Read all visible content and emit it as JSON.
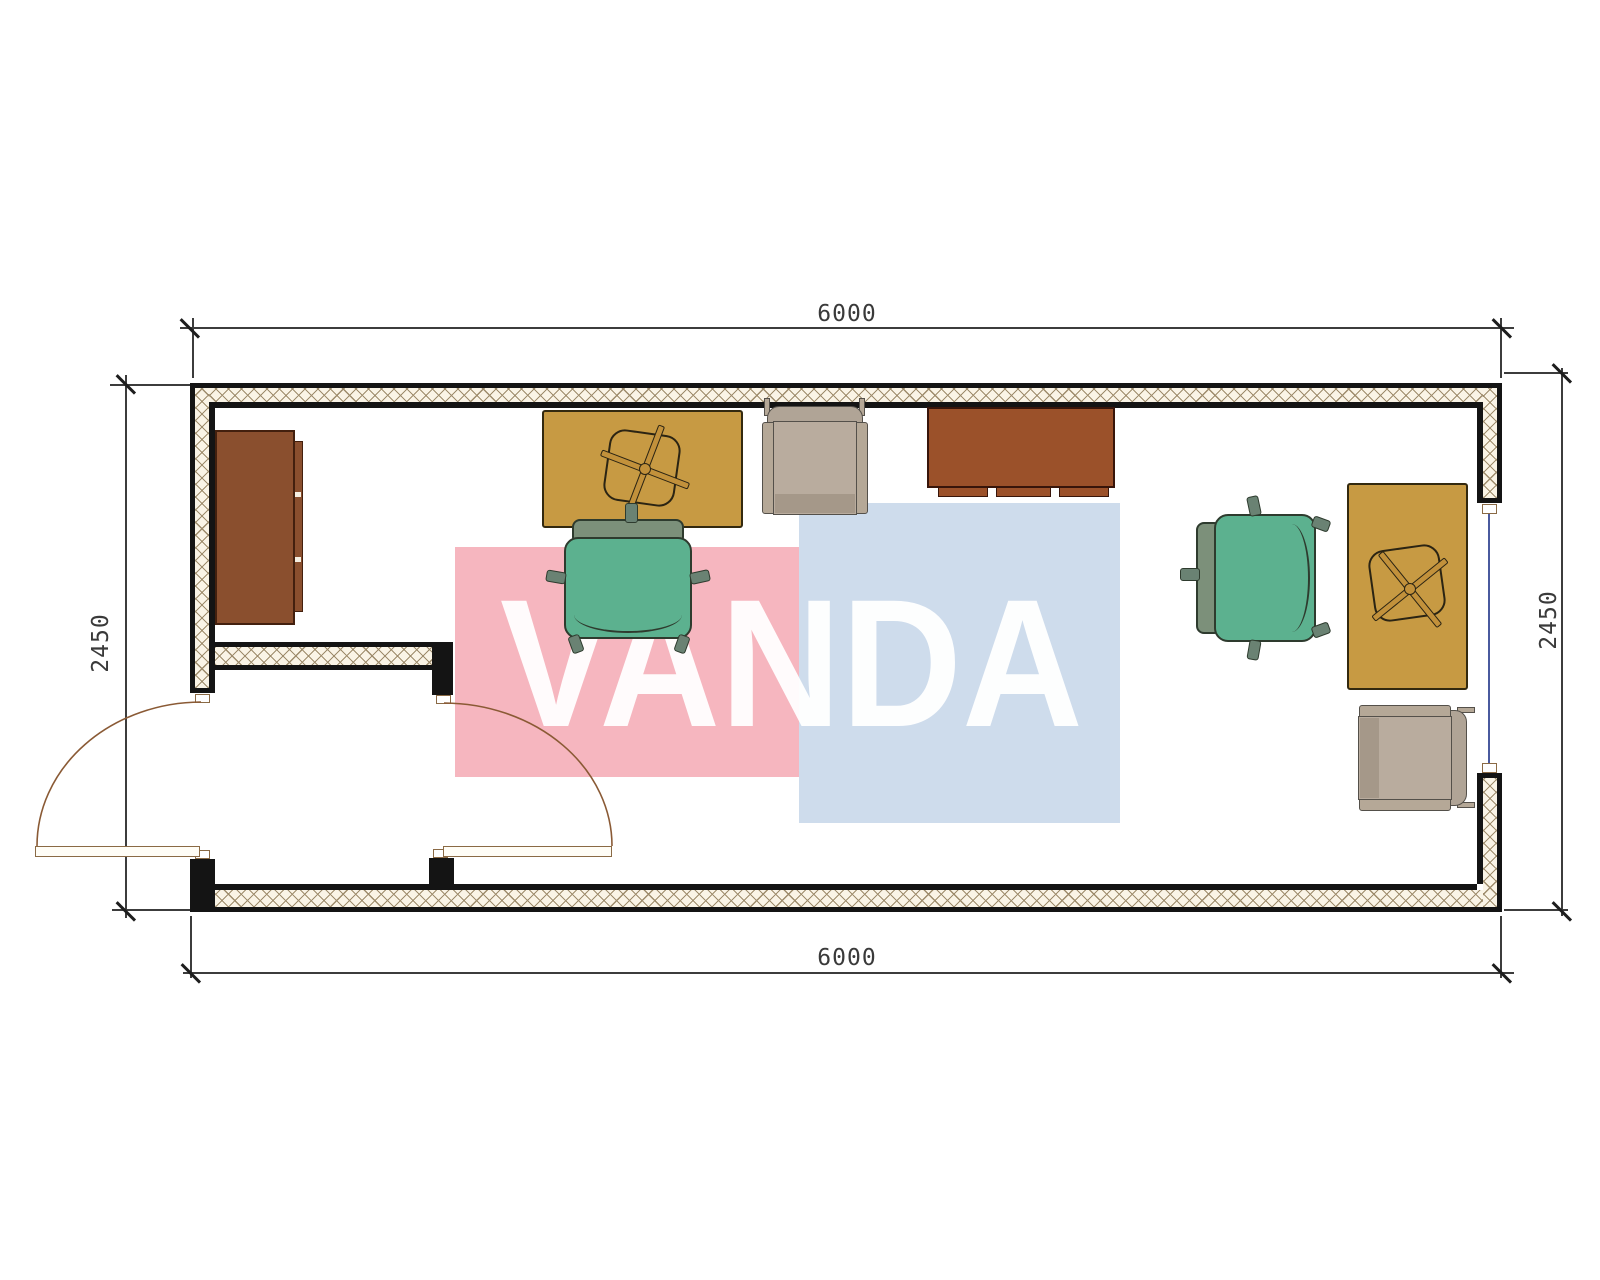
{
  "document": {
    "type": "architectural floor plan",
    "title": "container office plan 6000 x 2450",
    "watermark_text": "VANDA"
  },
  "dimensions": {
    "top": "6000",
    "bottom": "6000",
    "left": "2450",
    "right": "2450",
    "unit_implied": "mm"
  },
  "rooms": {
    "main_office": "open room with two workstations",
    "vestibule": "entry airlock at bottom-left with exterior and interior swing doors"
  },
  "openings": {
    "exterior_door": "left wall of vestibule, leaf shown open outward",
    "interior_door": "right wall of vestibule, leaf shown open into office",
    "window": "right exterior wall, glazing line between two sills"
  },
  "furniture": [
    {
      "name": "sideboard-cabinet",
      "color": "#8a4f2e"
    },
    {
      "name": "desk-left",
      "color": "#c79a43"
    },
    {
      "name": "desk-chair-symbol-left",
      "color": "#c2913b"
    },
    {
      "name": "office-chair-left",
      "color": "#5cb18f"
    },
    {
      "name": "guest-chair-left",
      "color": "#b5a897"
    },
    {
      "name": "credenza",
      "color": "#9b512a"
    },
    {
      "name": "office-chair-right",
      "color": "#5cb18f"
    },
    {
      "name": "desk-right",
      "color": "#c79a43"
    },
    {
      "name": "desk-chair-symbol-right",
      "color": "#c2913b"
    },
    {
      "name": "guest-chair-right",
      "color": "#b5a897"
    }
  ],
  "colors": {
    "wall_line": "#141414",
    "wall_hatch_line": "#9e8c6c",
    "wall_hatch_bg": "#faf4e6",
    "window_glass": "#4a5a9e",
    "door_swing": "#8a5a35",
    "dimension_line": "#3c3c3c",
    "watermark_pink": "#f6b6bf",
    "watermark_blue": "#cedcec",
    "watermark_letters": "#ffffff"
  }
}
